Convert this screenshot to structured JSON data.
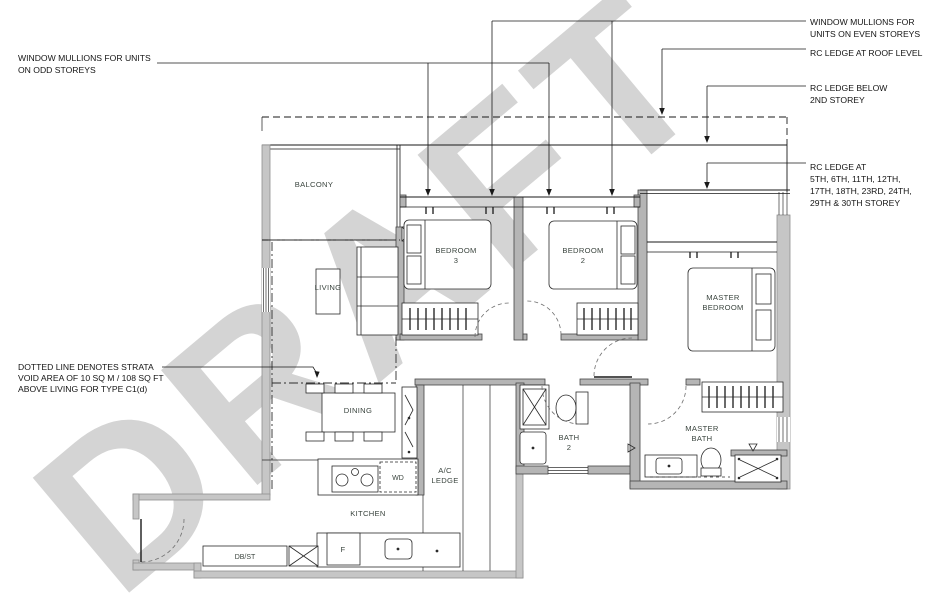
{
  "watermark": "DRAFT",
  "annotations": {
    "odd_mullions": [
      "WINDOW MULLIONS FOR UNITS",
      "ON ODD STOREYS"
    ],
    "even_mullions": [
      "WINDOW MULLIONS FOR",
      "UNITS ON EVEN STOREYS"
    ],
    "rc_roof": [
      "RC LEDGE AT ROOF LEVEL"
    ],
    "rc_below_2nd": [
      "RC LEDGE BELOW",
      "2ND STOREY"
    ],
    "rc_storeys": [
      "RC LEDGE AT",
      "5TH, 6TH, 11TH, 12TH,",
      "17TH, 18TH, 23RD, 24TH,",
      "29TH & 30TH STOREY"
    ],
    "strata_void": [
      "DOTTED LINE DENOTES STRATA",
      "VOID AREA OF 10 SQ M / 108 SQ FT",
      "ABOVE LIVING FOR TYPE C1(d)"
    ]
  },
  "rooms": {
    "balcony": "BALCONY",
    "living": "LIVING",
    "dining": "DINING",
    "kitchen": "KITCHEN",
    "bedroom3": [
      "BEDROOM",
      "3"
    ],
    "bedroom2": [
      "BEDROOM",
      "2"
    ],
    "master_bedroom": [
      "MASTER",
      "BEDROOM"
    ],
    "bath2": [
      "BATH",
      "2"
    ],
    "master_bath": [
      "MASTER",
      "BATH"
    ],
    "ac_ledge": [
      "A/C",
      "LEDGE"
    ],
    "wd": "WD",
    "fridge": "F",
    "dbst": "DB/ST"
  },
  "colors": {
    "exterior_wall": "#c6c6c6",
    "interior_wall": "#b5b5b5",
    "line": "#1a1a1a",
    "watermark": "#d4d4d4",
    "label": "#3a443e"
  }
}
